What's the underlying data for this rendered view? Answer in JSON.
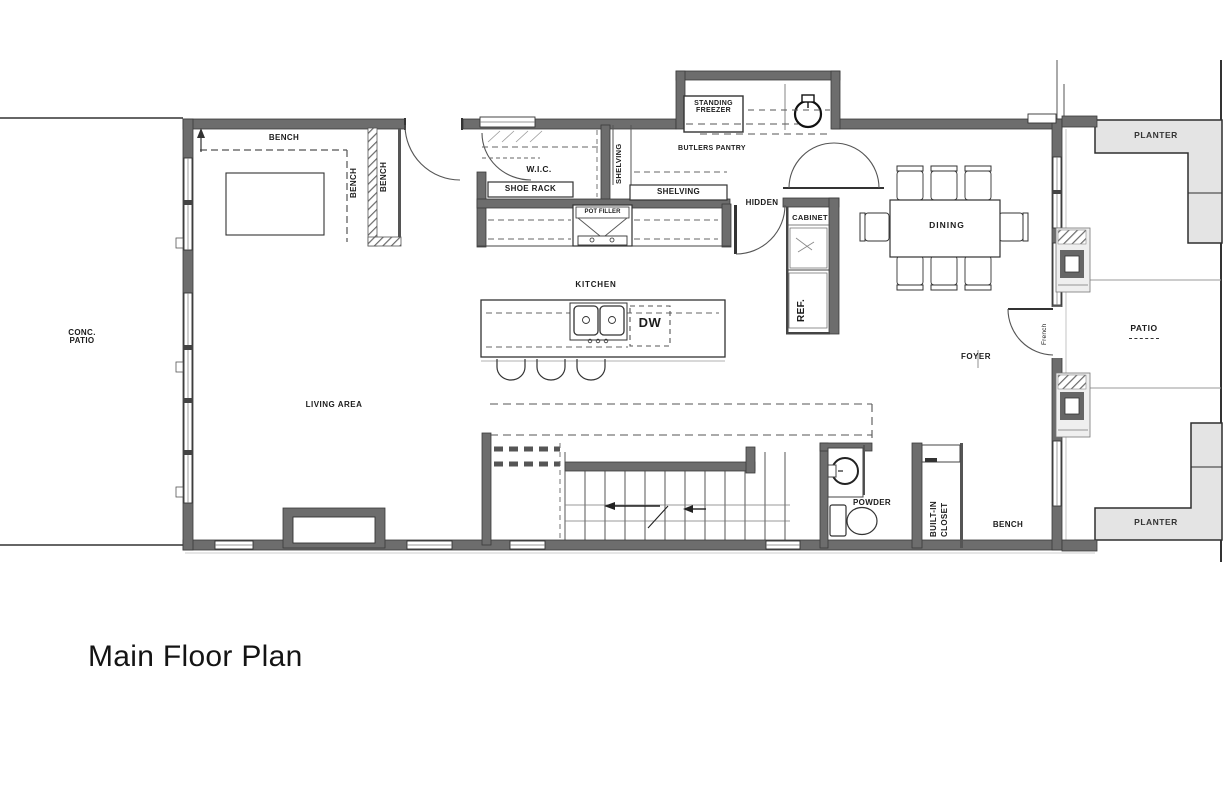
{
  "page": {
    "title": "Main Floor Plan"
  },
  "plan": {
    "rooms": {
      "living_area": "LIVING AREA",
      "kitchen": "KITCHEN",
      "dining": "DINING",
      "foyer": "FOYER",
      "wic": "W.I.C.",
      "butlers_pantry": "BUTLERS PANTRY",
      "powder": "POWDER"
    },
    "labels": {
      "bench_top": "BENCH",
      "bench_v1": "BENCH",
      "bench_v2": "BENCH",
      "bench_bottom": "BENCH",
      "shoe_rack": "SHOE RACK",
      "shelving_vertical": "SHELVING",
      "shelving_horizontal": "SHELVING",
      "standing_freezer_l1": "STANDING",
      "standing_freezer_l2": "FREEZER",
      "hidden": "HIDDEN",
      "cabinet": "CABINET",
      "ref": "REF.",
      "pot_filler": "POT FILLER",
      "dw": "DW",
      "french": "French",
      "built_in_closet_l1": "BUILT-IN",
      "built_in_closet_l2": "CLOSET",
      "conc_patio_l1": "CONC.",
      "conc_patio_l2": "PATIO",
      "patio": "PATIO",
      "planter_top": "PLANTER",
      "planter_bottom": "PLANTER"
    }
  }
}
